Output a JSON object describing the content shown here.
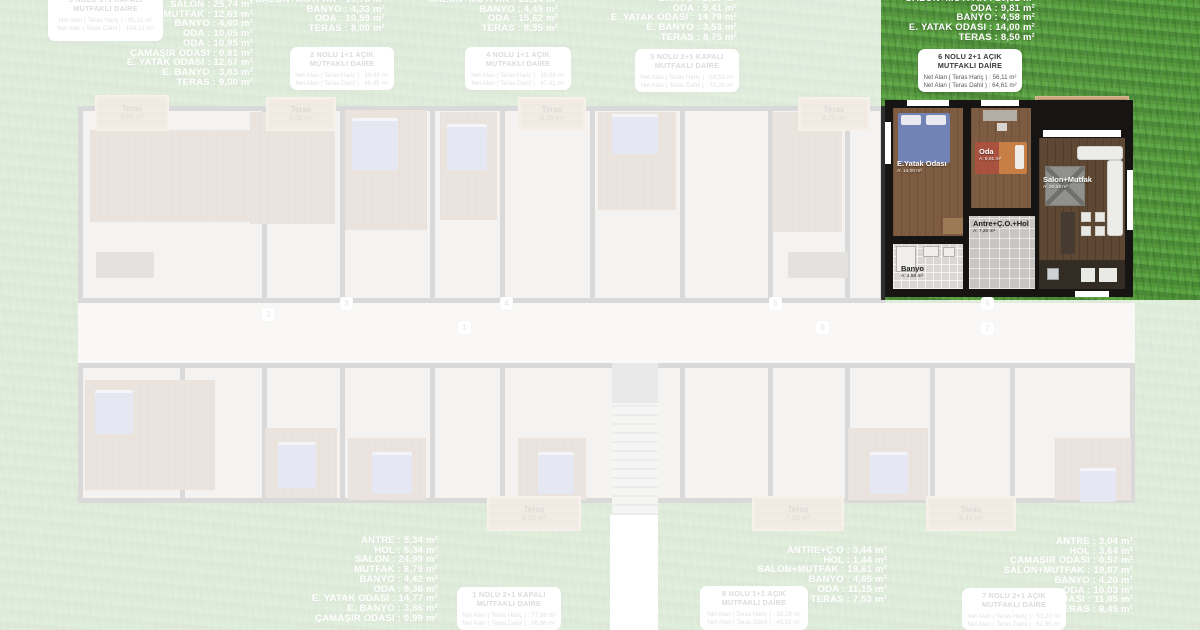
{
  "unit6": {
    "areas": [
      {
        "l": "SALON+MUTFAK",
        "v": "20,52 m²"
      },
      {
        "l": "ODA",
        "v": "9,81 m²"
      },
      {
        "l": "BANYO",
        "v": "4,58 m²"
      },
      {
        "l": "E. YATAK ODASI",
        "v": "14,00 m²"
      },
      {
        "l": "TERAS",
        "v": "8,50 m²"
      }
    ],
    "box": {
      "t1": "6 NOLU 2+1 AÇIK",
      "t2": "MUTFAKLI DAİRE",
      "n1": "Net Alan ( Teras Hariç ) : 56,11 m²",
      "n2": "Net Alan ( Teras Dahil ) : 64,61 m²"
    },
    "plan": {
      "teras": {
        "n": "Teras",
        "a": "8,50 m²"
      },
      "eyatak": {
        "n": "E.Yatak Odası",
        "a": "A: 14,00 m²"
      },
      "oda": {
        "n": "Oda",
        "a": "A: 9,81 m²"
      },
      "salon": {
        "n": "Salon+Mutfak",
        "a": "A: 20,52 m²"
      },
      "antre": {
        "n": "Antre+Ç.O.+Hol",
        "a": "A: 7,20 m²"
      },
      "banyo": {
        "n": "Banyo",
        "a": "A: 4,58 m²"
      }
    }
  },
  "faded": {
    "u3": {
      "rooms": [
        {
          "l": "SALON",
          "v": "25,74 m²"
        },
        {
          "l": "MUTFAK",
          "v": "12,61 m²"
        },
        {
          "l": "BANYO",
          "v": "4,60 m²"
        },
        {
          "l": "ODA",
          "v": "10,05 m²"
        },
        {
          "l": "ODA",
          "v": "10,95 m²"
        },
        {
          "l": "ÇAMAŞIR ODASI",
          "v": "0,81 m²"
        },
        {
          "l": "E. YATAK ODASI",
          "v": "12,57 m²"
        },
        {
          "l": "E. BANYO",
          "v": "3,83 m²"
        },
        {
          "l": "TERAS",
          "v": "9,00 m²"
        }
      ],
      "box": {
        "t1": "3 NOLU 3+1 KAPALI",
        "t2": "MUTFAKLI DAİRE",
        "n1": "Net Alan ( Teras Hariç ) : 95,21 m²",
        "n2": "Net Alan ( Teras Dahil ) : 104,21 m²"
      }
    },
    "u2": {
      "rooms": [
        {
          "l": "SALON+MUTFAK",
          "v": "19,73 m²"
        },
        {
          "l": "BANYO",
          "v": "4,33 m²"
        },
        {
          "l": "ODA",
          "v": "10,59 m²"
        },
        {
          "l": "TERAS",
          "v": "8,00 m²"
        }
      ],
      "box": {
        "t1": "2 NOLU 1+1 AÇIK",
        "t2": "MUTFAKLI DAİRE",
        "n1": "Net Alan ( Teras Hariç ) : 38,45 m²",
        "n2": "Net Alan ( Teras Dahil ) : 46,45 m²"
      }
    },
    "u4": {
      "rooms": [
        {
          "l": "SALON+MUTFAK",
          "v": "19,14 m²"
        },
        {
          "l": "BANYO",
          "v": "4,49 m²"
        },
        {
          "l": "ODA",
          "v": "15,62 m²"
        },
        {
          "l": "TERAS",
          "v": "8,35 m²"
        }
      ],
      "box": {
        "t1": "4 NOLU 1+1 AÇIK",
        "t2": "MUTFAKLI DAİRE",
        "n1": "Net Alan ( Teras Hariç ) : 39,06 m²",
        "n2": "Net Alan ( Teras Dahil ) : 47,41 m²"
      }
    },
    "u5": {
      "rooms": [
        {
          "l": "BANYO",
          "v": "2,89 m²"
        },
        {
          "l": "ODA",
          "v": "9,41 m²"
        },
        {
          "l": "E. YATAK ODASI",
          "v": "14,79 m²"
        },
        {
          "l": "E. BANYO",
          "v": "3,53 m²"
        },
        {
          "l": "TERAS",
          "v": "8,75 m²"
        }
      ],
      "box": {
        "t1": "5 NOLU 2+1 KAPALI",
        "t2": "MUTFAKLI DAİRE",
        "n1": "Net Alan ( Teras Hariç ) : 69,53 m²",
        "n2": "Net Alan ( Teras Dahil ) : 78,28 m²"
      }
    },
    "u1": {
      "rooms": [
        {
          "l": "ANTRE",
          "v": "5,34 m²"
        },
        {
          "l": "HOL",
          "v": "5,34 m²"
        },
        {
          "l": "SALON",
          "v": "24,99 m²"
        },
        {
          "l": "MUTFAK",
          "v": "8,79 m²"
        },
        {
          "l": "BANYO",
          "v": "4,42 m²"
        },
        {
          "l": "ODA",
          "v": "9,36 m²"
        },
        {
          "l": "E. YATAK ODASI",
          "v": "14,77 m²"
        },
        {
          "l": "E. BANYO",
          "v": "3,86 m²"
        },
        {
          "l": "ÇAMAŞIR ODASI",
          "v": "0,99 m²"
        }
      ],
      "box": {
        "t1": "1 NOLU 2+1 KAPALI",
        "t2": "MUTFAKLI DAİRE",
        "n1": "Net Alan ( Teras Hariç ) : 77,86 m²",
        "n2": "Net Alan ( Teras Dahil ) : 86,96 m²"
      }
    },
    "u8": {
      "rooms": [
        {
          "l": "ANTRE+Ç.O",
          "v": "3,44 m²"
        },
        {
          "l": "HOL",
          "v": "1,44 m²"
        },
        {
          "l": "SALON+MUTFAK",
          "v": "18,61 m²"
        },
        {
          "l": "BANYO",
          "v": "4,65 m²"
        },
        {
          "l": "ODA",
          "v": "11,15 m²"
        },
        {
          "l": "TERAS",
          "v": "7,53 m²"
        }
      ],
      "box": {
        "t1": "8 NOLU 1+1 AÇIK",
        "t2": "MUTFAKLI DAİRE",
        "n1": "Net Alan ( Teras Hariç ) : 38,29 m²",
        "n2": "Net Alan ( Teras Dahil ) : 45,82 m²"
      }
    },
    "u7": {
      "rooms": [
        {
          "l": "ANTRE",
          "v": "3,04 m²"
        },
        {
          "l": "HOL",
          "v": "3,64 m²"
        },
        {
          "l": "ÇAMAŞIR ODASI",
          "v": "0,57 m²"
        },
        {
          "l": "SALON+MUTFAK",
          "v": "19,87 m²"
        },
        {
          "l": "BANYO",
          "v": "4,20 m²"
        },
        {
          "l": "ODA",
          "v": "10,03 m²"
        },
        {
          "l": "E. YATAK ODASI",
          "v": "11,85 m²"
        },
        {
          "l": "TERAS",
          "v": "8,45 m²"
        }
      ],
      "box": {
        "t1": "7 NOLU 2+1 AÇIK",
        "t2": "MUTFAKLI DAİRE",
        "n1": "Net Alan ( Teras Hariç ) : 53,20 m²",
        "n2": "Net Alan ( Teras Dahil ) : 61,65 m²"
      }
    }
  },
  "terraces": {
    "t900": {
      "n": "Teras",
      "a": "9,00 m²"
    },
    "t800": {
      "n": "Teras",
      "a": "8,00 m²"
    },
    "t835": {
      "n": "Teras",
      "a": "8,35 m²"
    },
    "t875": {
      "n": "Teras",
      "a": "8,75 m²"
    },
    "t910": {
      "n": "Teras",
      "a": "9,10 m²"
    },
    "t753": {
      "n": "Teras",
      "a": "7,53 m²"
    },
    "t845": {
      "n": "Teras",
      "a": "8,45 m²"
    }
  },
  "badges": {
    "b1": "1",
    "b2": "2",
    "b3": "3",
    "b4": "4",
    "b5": "5",
    "b6": "6",
    "b7": "7",
    "b8": "8"
  }
}
